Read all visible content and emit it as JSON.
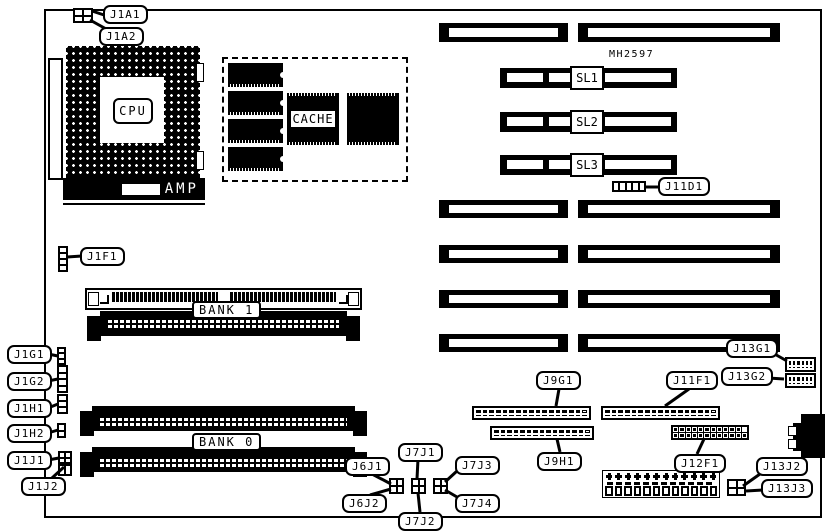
{
  "board": {
    "part_number": "MH2597"
  },
  "colors": {
    "line": "#000000",
    "background": "#ffffff"
  },
  "labels": {
    "cpu": "CPU",
    "cache": "CACHE",
    "amp": "AMP",
    "bank0": "BANK 0",
    "bank1": "BANK 1"
  },
  "slots": {
    "SL1": "SL1",
    "SL2": "SL2",
    "SL3": "SL3"
  },
  "callouts": {
    "J1A1": "J1A1",
    "J1A2": "J1A2",
    "J1F1": "J1F1",
    "J1G1": "J1G1",
    "J1G2": "J1G2",
    "J1H1": "J1H1",
    "J1H2": "J1H2",
    "J1J1": "J1J1",
    "J1J2": "J1J2",
    "J6J1": "J6J1",
    "J6J2": "J6J2",
    "J7J1": "J7J1",
    "J7J2": "J7J2",
    "J7J3": "J7J3",
    "J7J4": "J7J4",
    "J9G1": "J9G1",
    "J9H1": "J9H1",
    "J11D1": "J11D1",
    "J11F1": "J11F1",
    "J12F1": "J12F1",
    "J13G1": "J13G1",
    "J13G2": "J13G2",
    "J13J2": "J13J2",
    "J13J3": "J13J3"
  }
}
